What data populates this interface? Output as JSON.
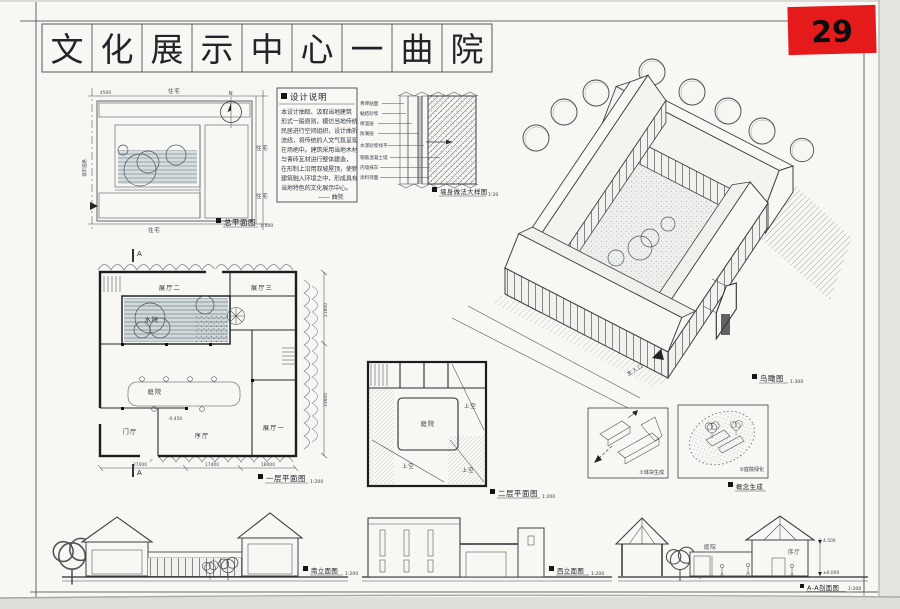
{
  "sheet": {
    "number": "29",
    "title_chars": [
      "文",
      "化",
      "展",
      "示",
      "中",
      "心",
      "一",
      "曲",
      "院"
    ]
  },
  "site_plan": {
    "caption": "总平面图",
    "scale": "1:500",
    "north_label": "N",
    "dim": "4500",
    "labels": {
      "top": "住宅",
      "right_upper": "住宅",
      "right_lower": "住宅",
      "bottom": "住宅",
      "road": "城市道路"
    }
  },
  "design_notes": {
    "title": "设计说明",
    "lines": [
      "本设计抽取、汲取当地建筑",
      "形式一般原则，模仿当地传统",
      "民居进行空间组织，设计曲折",
      "流线，将传统的人文气氛呈现",
      "在场地中。建筑采用当地木材",
      "与青砖瓦材进行整体建造，",
      "在形制上沿用双坡屋顶，使新",
      "建筑融入环境之中，形成具有",
      "当地特色的文化展示中心。"
    ],
    "signature": "—— 曲院"
  },
  "wall_detail": {
    "caption": "墙身做法大样图",
    "scale": "1:20",
    "materials": [
      "青砖贴面",
      "黏结砂浆",
      "保温层",
      "防潮层",
      "水泥砂浆找平",
      "钢筋混凝土墙",
      "内墙抹灰",
      "涂料饰面"
    ]
  },
  "axon": {
    "caption": "鸟瞰图",
    "scale": "1:300",
    "entrance_label": "主入口"
  },
  "plan1": {
    "caption": "一层平面图",
    "scale": "1:200",
    "section_mark": "A",
    "level": "-0.450",
    "rooms": {
      "hall2": "展厅二",
      "hall3": "展厅三",
      "water_court": "水院",
      "courtyard": "庭院",
      "foyer": "门厅",
      "lobby": "序厅",
      "hall1": "展厅一"
    },
    "dims_bottom": [
      "27000",
      "17400",
      "18000"
    ],
    "dims_right": [
      "21600",
      "33600"
    ]
  },
  "plan2": {
    "caption": "二层平面图",
    "scale": "1:200",
    "rooms": {
      "courtyard": "庭院",
      "void_a": "上空",
      "void_b": "上空",
      "void_c": "上空"
    }
  },
  "analysis": {
    "box1_label": "①体块生成",
    "box2_label": "②庭院绿化",
    "caption": "概念生成"
  },
  "elevations": {
    "south": {
      "caption": "南立面图",
      "scale": "1:200"
    },
    "west": {
      "caption": "西立面图",
      "scale": "1:200"
    },
    "section": {
      "caption": "A-A剖面图",
      "scale": "1:200",
      "court_label": "庭院",
      "hall_label": "序厅",
      "level_top": "4.500",
      "level_zero": "±0.000"
    }
  }
}
